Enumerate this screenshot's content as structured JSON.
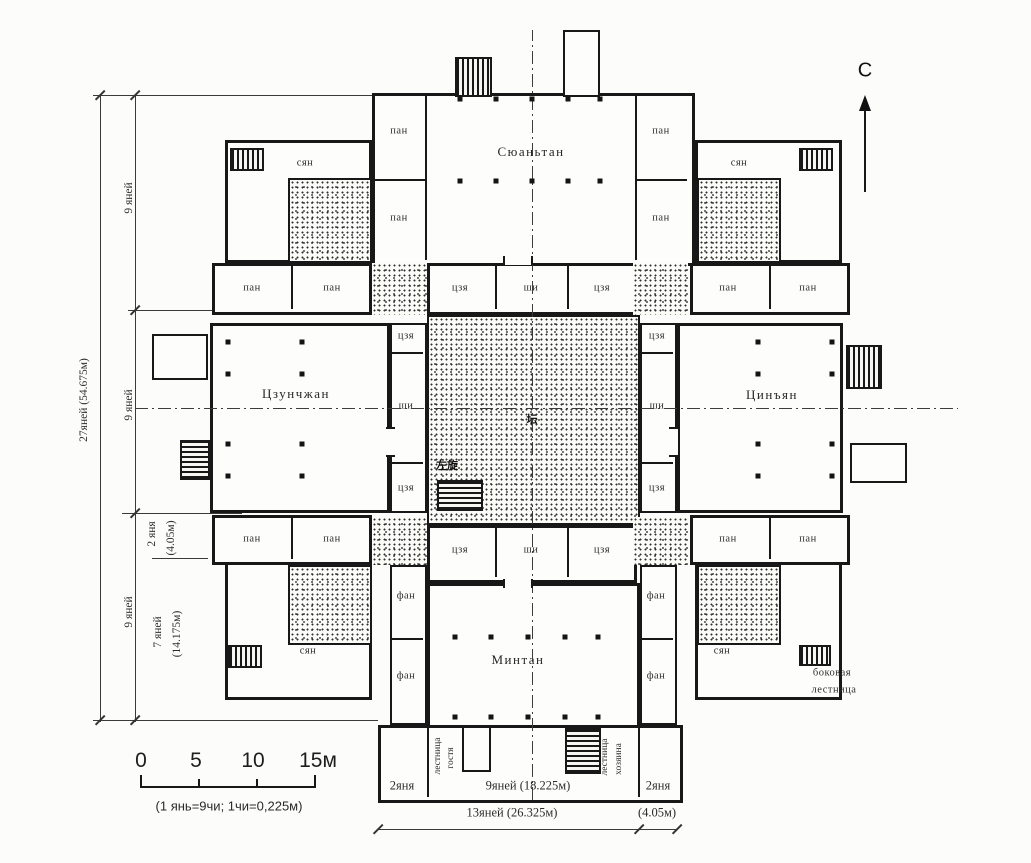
{
  "north": {
    "label": "С"
  },
  "halls": {
    "north_hall": "Сюаньтан",
    "west_hall": "Цзунчжан",
    "east_hall": "Цинъян",
    "south_hall": "Минтан"
  },
  "courtyard": {
    "center_mark": "坛",
    "stair_mark": "左旋"
  },
  "rooms": {
    "pan": "пан",
    "syan": "сян",
    "jia": "цзя",
    "shi": "ши",
    "fang": "фан"
  },
  "dims_left": {
    "total": "27яней (54.675м)",
    "seg9": "9 яней",
    "seg2": "2 яня",
    "seg2_m": "(4.05м)",
    "seg7": "7 яней",
    "seg7_m": "(14.175м)"
  },
  "dims_bottom": {
    "two_yan_left": "2яня",
    "nine_yan": "9яней (18.225м)",
    "two_yan_right": "2яня",
    "total_13": "13яней (26.325м)",
    "right_m": "(4.05м)"
  },
  "stairs": {
    "guest_line1": "лестница",
    "guest_line2": "гостя",
    "host_line1": "лестница",
    "host_line2": "хозяина",
    "side_line1": "боковая",
    "side_line2": "лестница"
  },
  "scale": {
    "t0": "0",
    "t5": "5",
    "t10": "10",
    "t15": "15м",
    "note": "(1 янь=9чи; 1чи=0,225м)"
  }
}
